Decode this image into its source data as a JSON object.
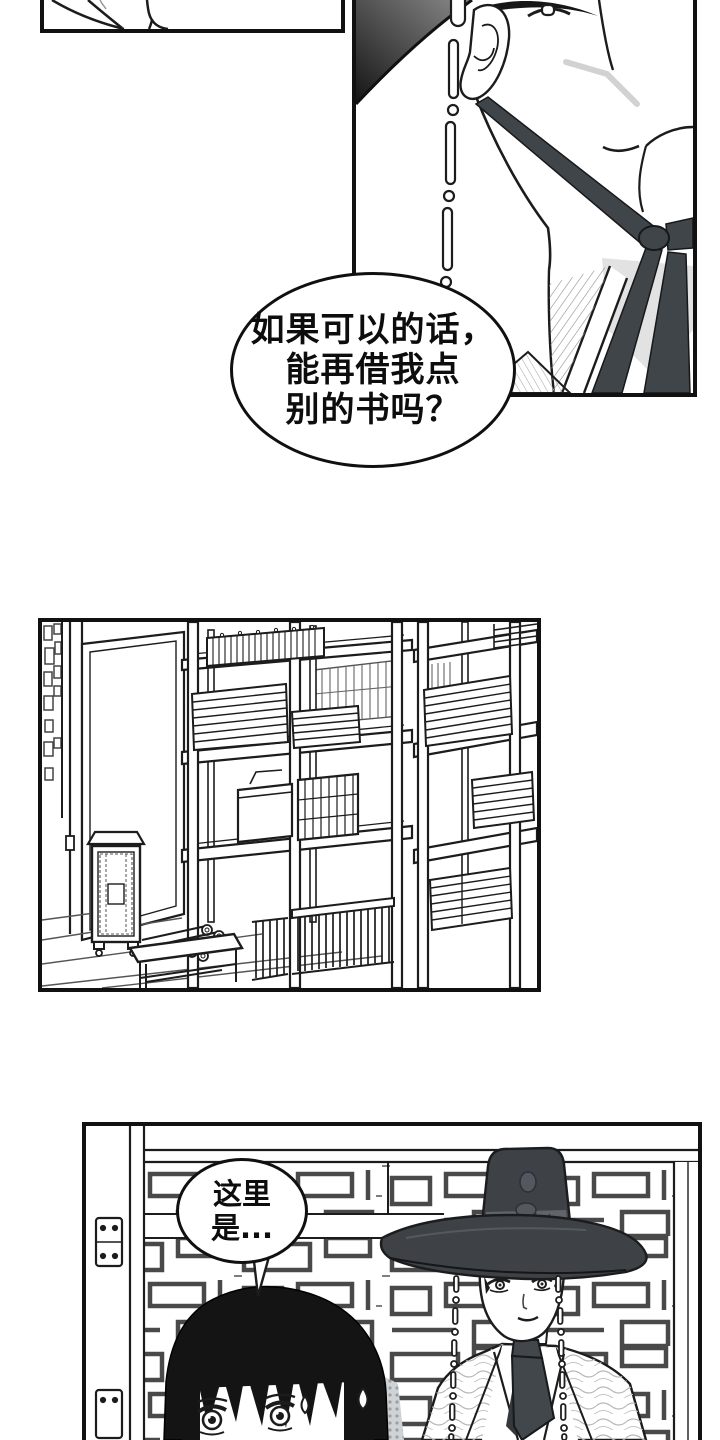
{
  "page": {
    "background": "#ffffff",
    "ink": "#1c1c1c"
  },
  "colors": {
    "hat_dark": "#3e4247",
    "ribbon_dark": "#42474c",
    "shadow_gray": "#cfd3d5",
    "hatch_gray": "#8f8f8f",
    "paper": "#ffffff"
  },
  "speech_bubbles": {
    "bubble1": {
      "line1": "如果可以的话，",
      "line2": "能再借我点",
      "line3": "别的书吗？"
    },
    "bubble2": {
      "line1": "这里",
      "line2": "是..."
    }
  }
}
